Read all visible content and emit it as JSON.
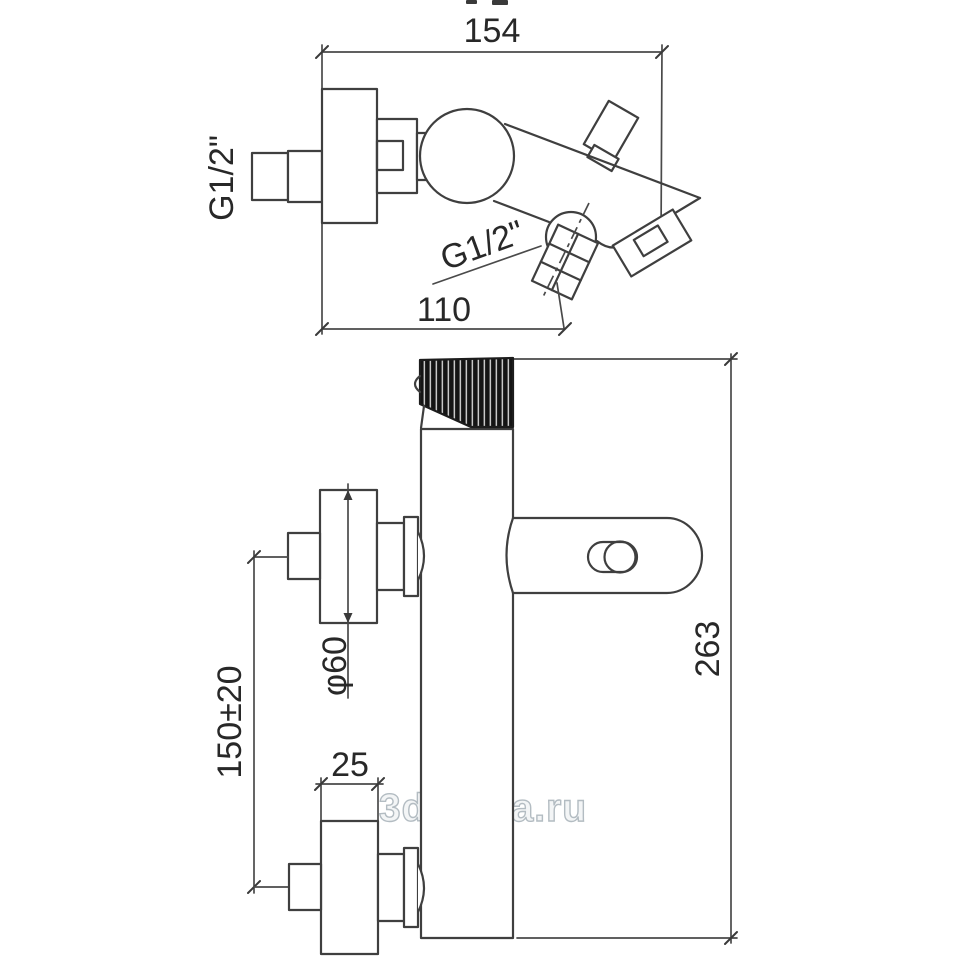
{
  "views": {
    "top": {
      "dim_width": "154",
      "dim_spout": "110",
      "thread_wall": "G1/2\"",
      "thread_shower": "G1/2\""
    },
    "front": {
      "dim_height": "263",
      "dim_supply_spacing": "150±20",
      "dim_flange_depth": "25",
      "dia_flange": "φ60"
    }
  },
  "watermark": {
    "text": "3dplitka.ru"
  },
  "colors": {
    "background": "#ffffff",
    "line": "#3f3f3f",
    "dimension_line": "#4a4a4a",
    "text": "#282828",
    "watermark_stroke": "#b3bcc2",
    "watermark_fill": "#f3f5f6",
    "knurl_dark": "#141414"
  }
}
